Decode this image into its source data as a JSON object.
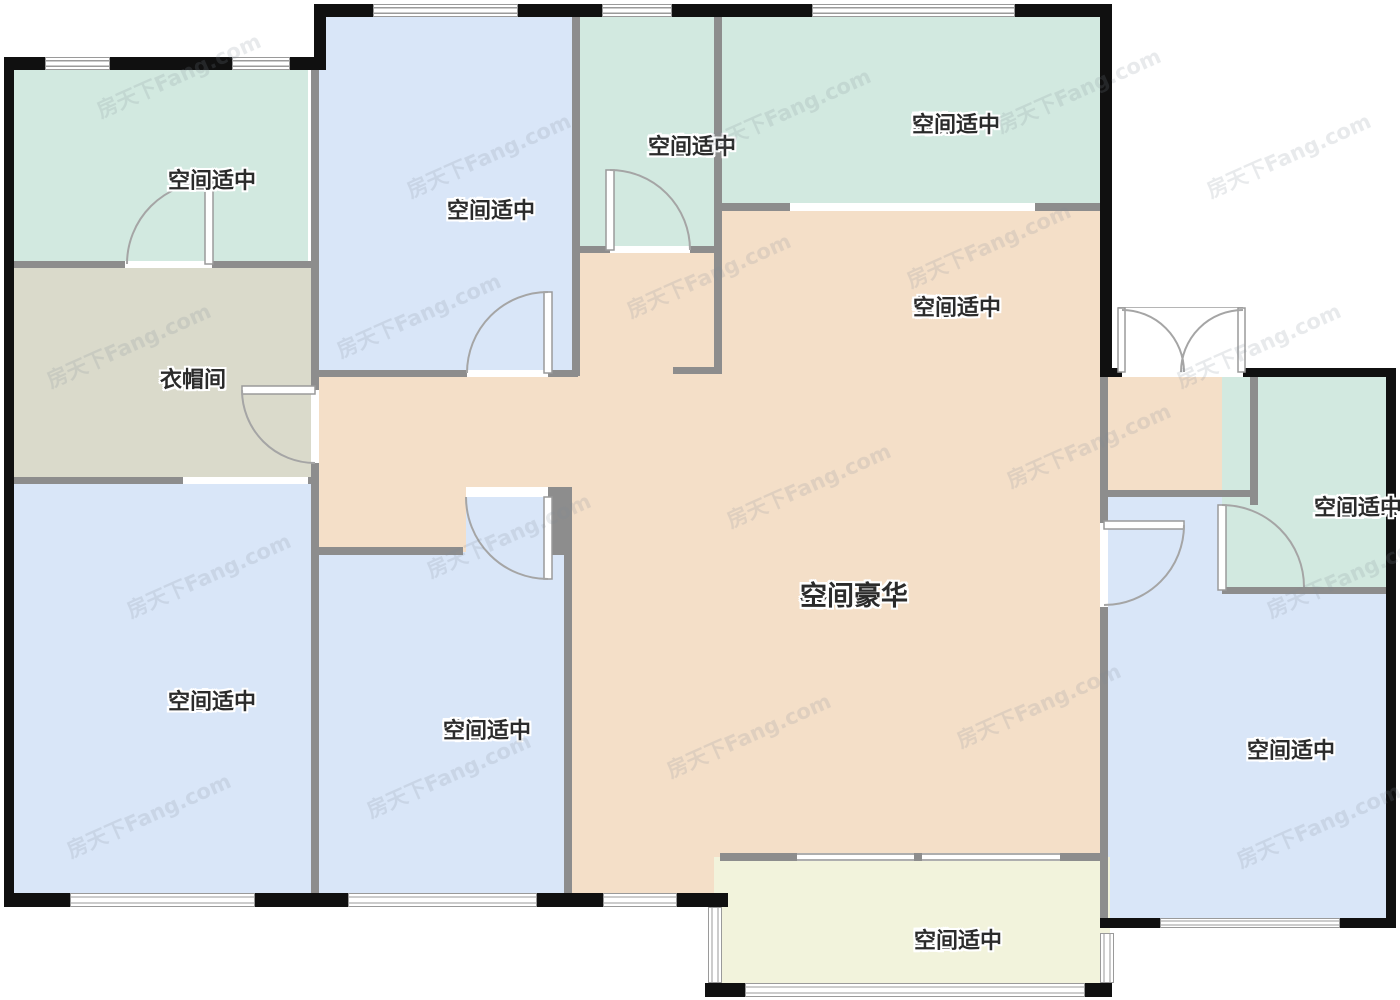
{
  "floorplan": {
    "watermark": "房天下Fang.com",
    "colors": {
      "bedroom": "#d9e6f8",
      "bath": "#d2e9e0",
      "kitchen": "#d2e9e0",
      "living": "#f4dfc8",
      "cloakroom": "#dadacb",
      "balcony": "#f2f3dc",
      "outer_wall": "#101010",
      "inner_wall": "#8d8d8d"
    },
    "rooms": [
      {
        "id": "master-bath",
        "name": "主卫",
        "desc": "空间适中"
      },
      {
        "id": "bedroom-a",
        "name": "卧室A",
        "desc": "空间适中"
      },
      {
        "id": "bathroom",
        "name": "卫生间",
        "desc": "空间适中"
      },
      {
        "id": "kitchen",
        "name": "厨房",
        "desc": "空间适中"
      },
      {
        "id": "dining",
        "name": "餐厅",
        "desc": "空间适中"
      },
      {
        "id": "cloakroom",
        "name": "衣帽间",
        "desc": ""
      },
      {
        "id": "living",
        "name": "客厅",
        "desc": "空间豪华"
      },
      {
        "id": "bathroom-a",
        "name": "卫生间A",
        "desc": "空间适中"
      },
      {
        "id": "master-bedroom",
        "name": "主卧",
        "desc": "空间适中"
      },
      {
        "id": "bedroom-b",
        "name": "卧室B",
        "desc": "空间适中"
      },
      {
        "id": "bedroom-c",
        "name": "卧室C",
        "desc": "空间适中"
      },
      {
        "id": "balcony",
        "name": "阳台",
        "desc": "空间适中"
      }
    ]
  }
}
